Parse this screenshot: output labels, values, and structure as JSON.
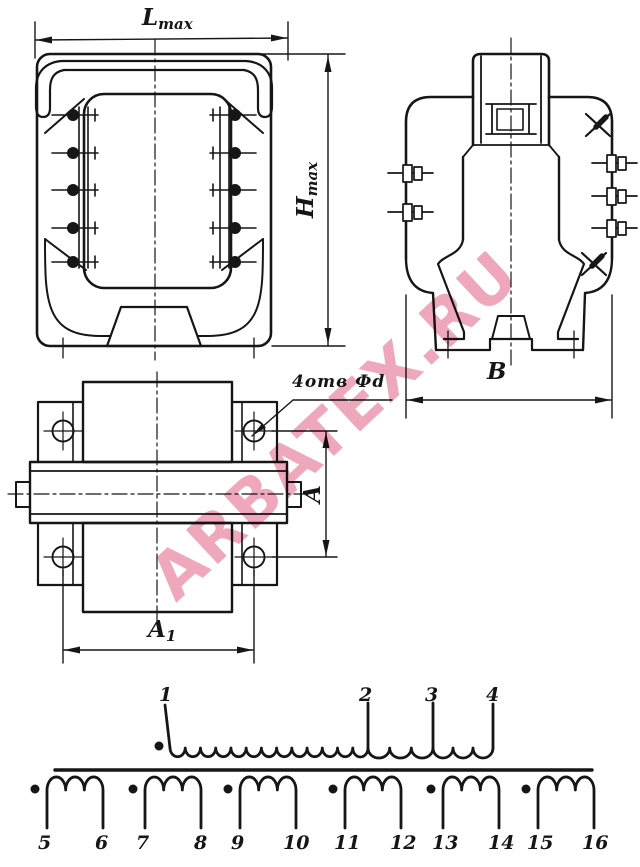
{
  "watermark": {
    "text": "ARBATEX.RU",
    "color": "#e56e8d"
  },
  "drawing": {
    "line_color": "#161616",
    "background": "#ffffff"
  },
  "dimensions": {
    "length_max": {
      "main": "L",
      "sub": "max"
    },
    "height_max": {
      "main": "H",
      "sub": "max"
    },
    "depth": {
      "main": "В"
    },
    "hole_spacing_vertical": {
      "main": "A"
    },
    "hole_spacing_horizontal": {
      "main": "A",
      "sub": "1"
    },
    "holes_note": {
      "text": "4отв Фd"
    }
  },
  "schematic": {
    "primary_terminals": [
      "1",
      "2",
      "3",
      "4"
    ],
    "secondary_terminals": [
      "5",
      "6",
      "7",
      "8",
      "9",
      "10",
      "11",
      "12",
      "13",
      "14",
      "15",
      "16"
    ]
  }
}
